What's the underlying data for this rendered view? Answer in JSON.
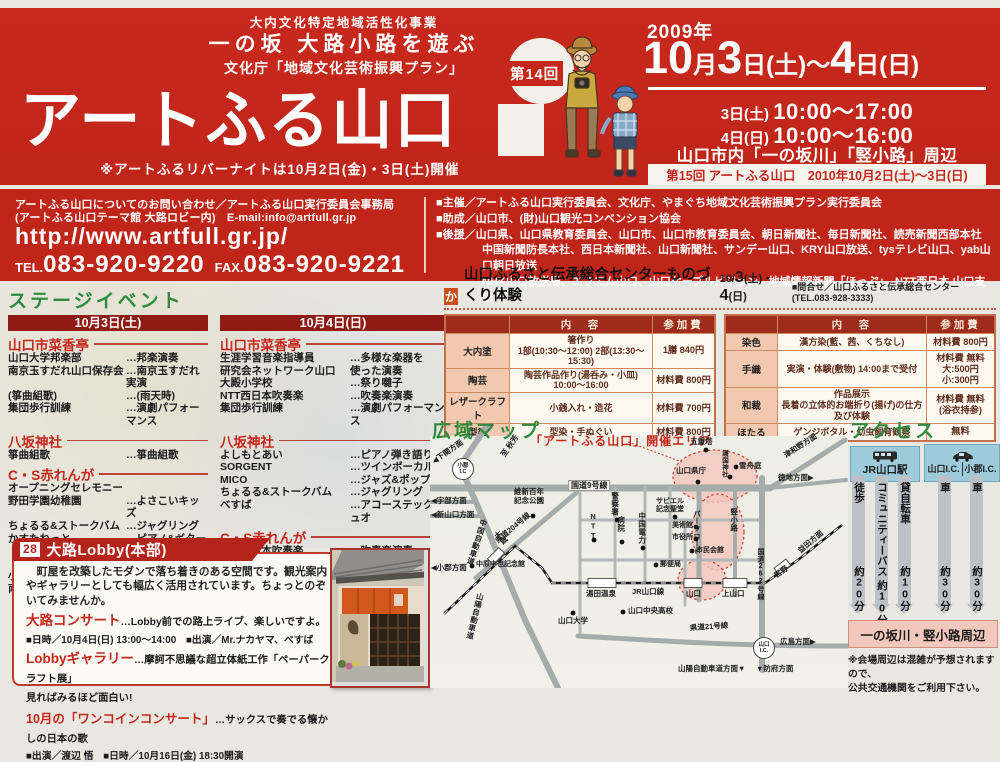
{
  "colors": {
    "banner_red": "#c5271b",
    "bar_dark_red": "#8e1c15",
    "heading_green": "#2e8b3d",
    "table_header_red": "#9e2b1c",
    "table_pink": "#f2c8ae",
    "access_blue": "#9ecbdb",
    "event_area_pink": "#f3c6bd"
  },
  "header": {
    "program1": "大内文化特定地域活性化事業",
    "program2": "一の坂 大路小路を遊ぶ",
    "program3": "文化庁「地域文化芸術振興プラン」",
    "title": "アートふる山口",
    "edition": "第14回",
    "river_note": "※アートふるリバーナイトは10月2日(金)・3日(土)開催",
    "year": "2009年",
    "date_parts": [
      "10",
      "月",
      "3",
      "日(土)",
      "～",
      "4",
      "日(日)"
    ],
    "hours1a": "3日(土) ",
    "hours1b": "10:00～17:00",
    "hours2a": "4日(日) ",
    "hours2b": "10:00～16:00",
    "venue": "山口市内「一の坂川」「竪小路」周辺",
    "next": "第15回 アートふる山口　2010年10月2日(土)～3日(日)"
  },
  "contact": {
    "line1": "アートふる山口についてのお問い合わせ／アートふる山口実行委員会事務局",
    "line2": "(アートふる山口テーマ館 大路ロビー内)　E-mail:info@artfull.gr.jp",
    "url": "http://www.artfull.gr.jp/",
    "tel_label": "TEL.",
    "tel": "083-920-9220",
    "fax_label": "FAX.",
    "fax": "083-920-9221"
  },
  "organizers": {
    "line1": "■主催／アートふる山口実行委員会、文化庁、やまぐち地域文化芸術振興プラン実行委員会",
    "line2": "■助成／山口市、(財)山口観光コンベンション協会",
    "line3": "■後援／山口県、山口県教育委員会、山口市、山口市教育委員会、朝日新聞社、毎日新聞社、読売新聞西部本社",
    "line4": "中国新聞防長本社、西日本新聞社、山口新聞社、サンデー山口、KRY山口放送、tysテレビ山口、yab山口朝日放送",
    "line5": "NHK山口放送局、エフエム山口、山口ケーブルビジョン、地域情報新聞「ほっぷ」、NTT西日本 山口支店"
  },
  "stage": {
    "title": "ステージイベント",
    "days": [
      {
        "date": "10月3日(土)",
        "venues": [
          {
            "name": "山口市菜香亭",
            "acts": [
              {
                "n": "山口大学邦楽部",
                "t": "…邦楽演奏"
              },
              {
                "n": "南京玉すだれ山口保存会",
                "t": "…南京玉すだれ実演"
              },
              {
                "n": "(箏曲組歌)",
                "t": "…(雨天時)"
              },
              {
                "n": "集団歩行訓練",
                "t": "…演劇パフォーマンス"
              }
            ]
          },
          {
            "name": "八坂神社",
            "acts": [
              {
                "n": "箏曲組歌",
                "t": "…箏曲組歌"
              }
            ]
          },
          {
            "name": "C・S赤れんが",
            "acts": [
              {
                "n": "オープニングセレモニー",
                "t": ""
              },
              {
                "n": "野田学園幼稚園",
                "t": "…よさこいキッズ"
              },
              {
                "n": "ちょるる&ストークバム",
                "t": "…ジャグリング"
              },
              {
                "n": "かすたねっと",
                "t": "…ピアノ&ギターの\nツインボーカル"
              },
              {
                "n": "小野田竜王太鼓",
                "t": "…太鼓演奏"
              },
              {
                "n": "南京玉すだれ山口保存会",
                "t": "…南京玉すだれ実演"
              }
            ]
          }
        ]
      },
      {
        "date": "10月4日(日)",
        "venues": [
          {
            "name": "山口市菜香亭",
            "acts": [
              {
                "n": "生涯学習音楽指導員\n研究会ネットワーク山口",
                "t": "…多様な楽器を\n使った演奏"
              },
              {
                "n": "大殿小学校",
                "t": "…祭り囃子"
              },
              {
                "n": "NTT西日本吹奏楽",
                "t": "…吹奏楽演奏"
              },
              {
                "n": "集団歩行訓練",
                "t": "…演劇パフォーマンス"
              }
            ]
          },
          {
            "name": "八坂神社",
            "acts": [
              {
                "n": "よしもとあい",
                "t": "…ピアノ弾き語り"
              },
              {
                "n": "SORGENT",
                "t": "…ツインボーカル"
              },
              {
                "n": "MICO",
                "t": "…ジャズ&ポップス"
              },
              {
                "n": "ちょるる&ストークバム",
                "t": "…ジャグリング"
              },
              {
                "n": "べすば",
                "t": "…アコーステックデュオ"
              }
            ]
          },
          {
            "name": "C・S赤れんが",
            "acts": [
              {
                "n": "NTT西日本吹奏楽",
                "t": "…吹奏楽演奏"
              },
              {
                "n": "小野田竜王太鼓",
                "t": "…太鼓演奏"
              },
              {
                "n": "アートオブブラスYAMAGUCHI",
                "t": "…ブラスバンド"
              },
              {
                "n": "森川ヤスヒロ",
                "t": "…バグパイプ"
              }
            ]
          }
        ]
      }
    ]
  },
  "workshop": {
    "badge": "か",
    "title": "山口ふるさと伝承総合センターものづくり体験",
    "date_parts": [
      "10/",
      "3",
      "(土)・",
      "4",
      "(日)"
    ],
    "inquiry": "■問合せ／山口ふるさと伝承総合センター(TEL.083-928-3333)",
    "head_content": "内　容",
    "head_fee": "参加費",
    "left_rows": [
      {
        "label": "大内塗",
        "content": "箸作り\n1部(10:30～12:00) 2部(13:30～15:30)",
        "fee": "1膳 840円"
      },
      {
        "label": "陶芸",
        "content": "陶芸作品作り(湯呑み・小皿)\n10:00～16:00",
        "fee": "材料費 800円"
      },
      {
        "label": "レザークラフト",
        "content": "小銭入れ・造花",
        "fee": "材料費 700円"
      },
      {
        "label": "型染",
        "content": "型染・手ぬぐい",
        "fee": "材料費 800円"
      }
    ],
    "right_rows": [
      {
        "label": "染色",
        "content": "漢方染(藍、茜、くちなし)",
        "fee": "材料費 800円"
      },
      {
        "label": "手織",
        "content": "実演・体験(敷物) 14:00まで受付",
        "fee": "材料費 無料\n大:500円 小:300円"
      },
      {
        "label": "和裁",
        "content": "作品展示\n長着の立体的お端折り(揚げ)の仕方及び体験",
        "fee": "材料費 無料\n(浴衣持参)"
      },
      {
        "label": "ほたる",
        "content": "ゲンジボタル・幼虫飼育観察",
        "fee": "無料"
      }
    ]
  },
  "lobby": {
    "number": "28",
    "title": "大路Lobby(本部)",
    "desc": "　町屋を改築したモダンで落ち着きのある空間です。観光案内やギャラリーとしても幅広く活用されています。ちょっとのぞいてみませんか。",
    "concert_title": "大路コンサート",
    "concert_desc": "…Lobby前での路上ライブ、楽しいですよ。",
    "concert_info": "■日時／10月4日(日) 13:00～14:00　■出演／Mr.ナカヤマ、べすば",
    "gallery_title": "Lobbyギャラリー",
    "gallery_desc": "…摩訶不思議な超立体紙工作「ペーパークラフト展」\n見ればみるほど面白い!",
    "onecoin_title": "10月の「ワンコインコンサート」",
    "onecoin_desc": "…サックスで奏でる懐かしの日本の歌",
    "onecoin_info": "■出演／渡辺 悟　■日時／10月16日(金) 18:30開演"
  },
  "map": {
    "title": "広域マップ",
    "area_label": "「アートふる山口」開催エリア",
    "labels": {
      "akiyoshi": "至 秋芳",
      "shimonoseki": "◀下関方面",
      "ogori_ic": "小郡\nI.C",
      "ube": "◀宇部方面",
      "shin_yamaguchi": "◀新山口方面",
      "chugoku_expwy": "中国自動車道",
      "ozoe": "大歳",
      "ogori": "◀小郡方面",
      "sanyo_expwy": "山陽自動車道",
      "r204": "県道204号線",
      "ishin_park": "維新百年\n記念公園",
      "r9": "国道9号線",
      "police": "警察署",
      "ntt": "NTT",
      "hospital": "病院",
      "chugoku_elec": "中国電力",
      "xavier": "サビエル\n記念聖堂",
      "museum": "美術館",
      "cityhall": "市役所",
      "civic_hall": "市民会館",
      "chuya_museum": "中原中也記念館",
      "post_office": "郵便局",
      "yuda_onsen": "湯田温泉",
      "jr_line": "JR山口線",
      "yamaguchi_sta": "山口",
      "kami_yamaguchi": "上山口",
      "miyano": "宮野",
      "masuda": "益田方面",
      "pagoda": "五重塔",
      "gokoku": "護国神社",
      "sesshu": "雪舟庭",
      "kencho": "山口県庁",
      "tsuwano": "津和野方面",
      "tokuji": "徳地方面▶",
      "tatekoji": "竪小路",
      "parkroad": "パークロード",
      "r262": "国道262号線",
      "univ": "山口大学",
      "chuo_hs": "山口中央高校",
      "r21": "県道21号線",
      "yamaguchi_ic": "山口\nI.C.",
      "hiroshima": "広島方面▶",
      "sanyo_dir": "山陽自動車道方面▼",
      "hofu": "▼防府方面"
    }
  },
  "access": {
    "title": "アクセス",
    "from_station": "JR山口駅",
    "from_ic1": "山口I.C.",
    "from_ic2": "小郡I.C.",
    "modes": [
      {
        "label": "徒歩",
        "time": "約20分"
      },
      {
        "label": "コミュニティーバス",
        "time": "約10分"
      },
      {
        "label": "貸自転車",
        "time": "約10分"
      },
      {
        "label": "車",
        "time": "約30分"
      },
      {
        "label": "車",
        "time": "約30分"
      }
    ],
    "destination": "一の坂川・竪小路周辺",
    "note": "※会場周辺は混雑が予想されますので、\n公共交通機関をご利用下さい。"
  }
}
